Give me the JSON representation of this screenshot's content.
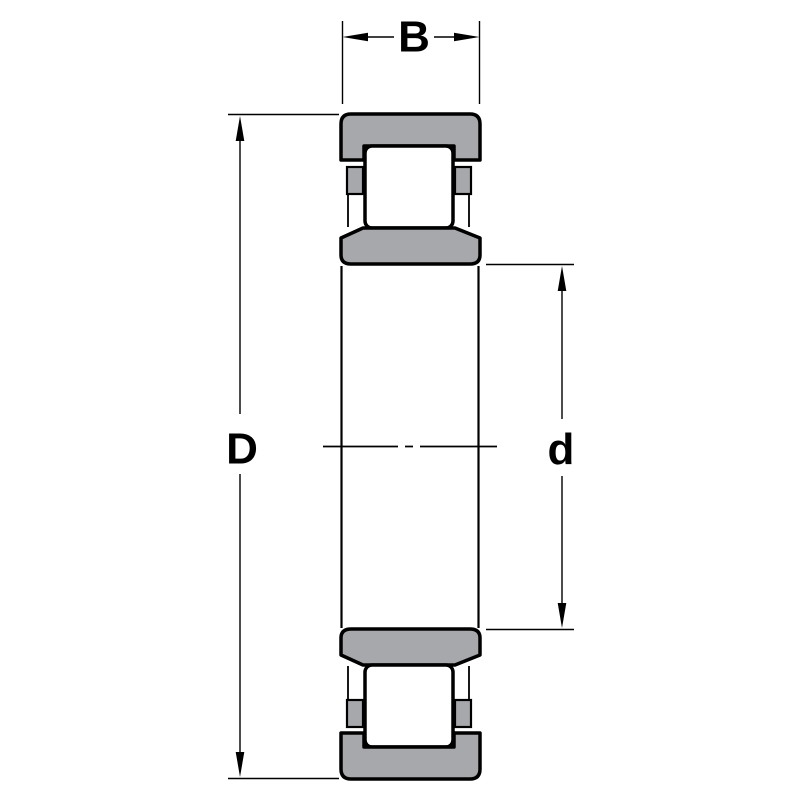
{
  "drawing": {
    "labels": {
      "width": "B",
      "outer_diameter": "D",
      "bore_diameter": "d"
    },
    "colors": {
      "ring_fill": "#a6a8ab",
      "roller_fill": "#ffffff",
      "line": "#000000",
      "background": "#ffffff"
    }
  }
}
